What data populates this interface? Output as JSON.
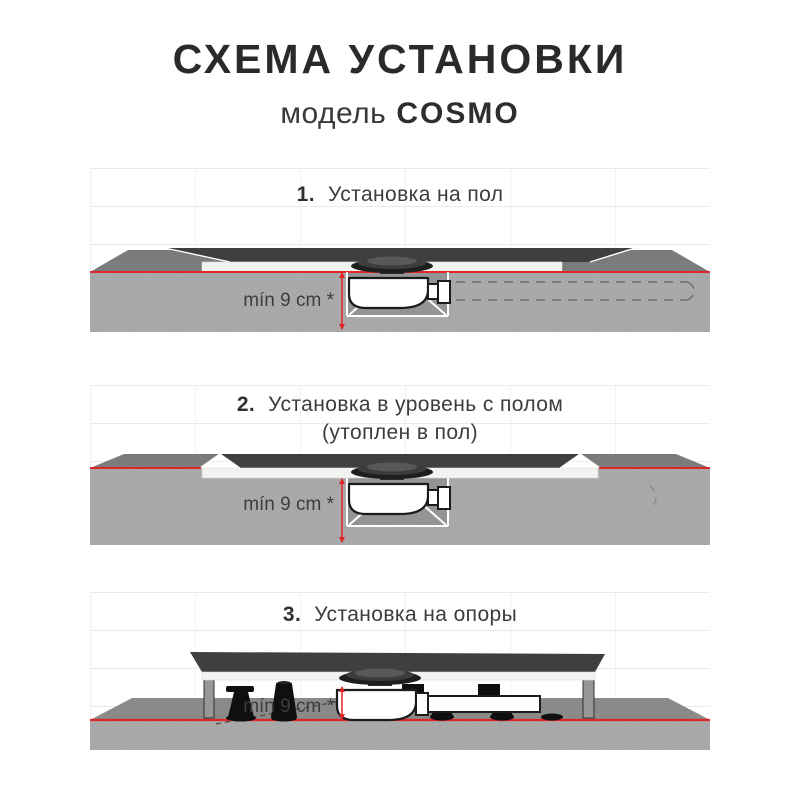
{
  "header": {
    "title": "СХЕМА УСТАНОВКИ",
    "model_label": "модель",
    "model_name": "COSMO"
  },
  "sections": [
    {
      "number": "1.",
      "title": "Установка на пол",
      "dimension_label": "mín 9 cm *"
    },
    {
      "number": "2.",
      "title": "Установка в уровень с полом",
      "title_line2": "(утоплен в пол)",
      "dimension_label": "mín 9 cm *"
    },
    {
      "number": "3.",
      "title": "Установка на опоры",
      "dimension_label": "mín 9 cm *"
    }
  ],
  "colors": {
    "accent_red": "#e02626",
    "tray_dark": "#3f3f3f",
    "floor_plane": "#7b7b7b",
    "slab_gray": "#a9a9a9",
    "base_white": "#f2f2f0",
    "text_dark": "#2a2a2a"
  }
}
